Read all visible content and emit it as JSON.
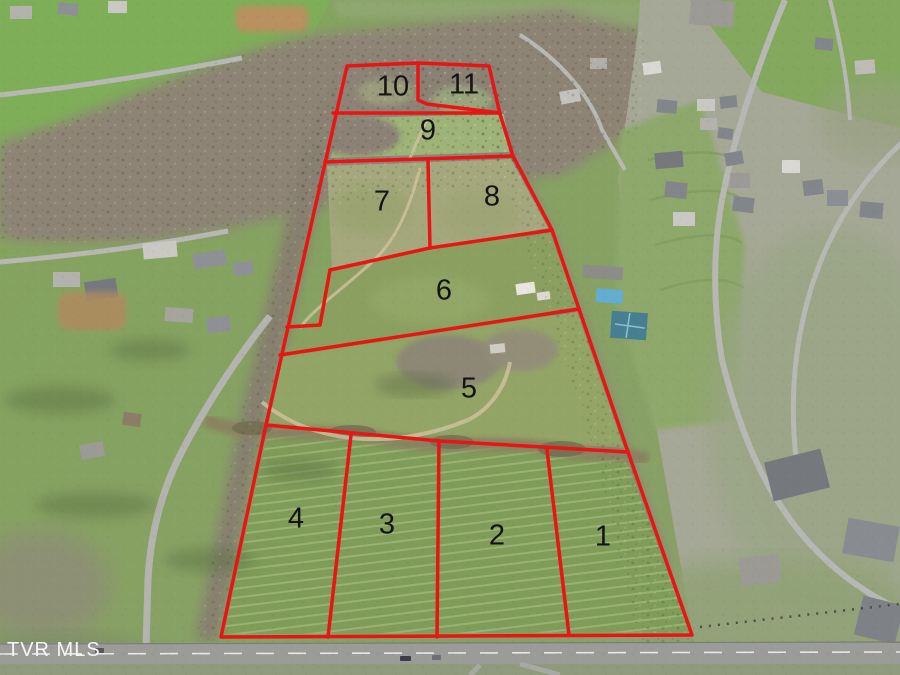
{
  "watermark": {
    "text": "TVR MLS"
  },
  "overlay": {
    "color": "#e91414",
    "stroke_width": 3.5,
    "parcels": [
      {
        "number": "1",
        "x": 603,
        "y": 537
      },
      {
        "number": "2",
        "x": 497,
        "y": 536
      },
      {
        "number": "3",
        "x": 387,
        "y": 525
      },
      {
        "number": "4",
        "x": 296,
        "y": 519
      },
      {
        "number": "5",
        "x": 469,
        "y": 389
      },
      {
        "number": "6",
        "x": 444,
        "y": 291
      },
      {
        "number": "7",
        "x": 382,
        "y": 202
      },
      {
        "number": "8",
        "x": 492,
        "y": 197
      },
      {
        "number": "9",
        "x": 428,
        "y": 131
      },
      {
        "number": "10",
        "x": 393,
        "y": 87
      },
      {
        "number": "11",
        "x": 464,
        "y": 85
      }
    ],
    "boundaries": [
      {
        "name": "outer-boundary",
        "points": "347,66 418,63 489,66 500,114 513,156 552,230 579,309 628,452 692,635 221,637 266,425 347,66"
      },
      {
        "name": "lot-10-11-divider",
        "points": "418,63 418,100 427,104 500,113"
      },
      {
        "name": "lot-9-north-line",
        "points": "333,113 500,113"
      },
      {
        "name": "lot-7-8-north-line",
        "points": "325,162 513,156"
      },
      {
        "name": "lot-7-8-divider",
        "points": "428,161 430,248"
      },
      {
        "name": "lot-6-north-line",
        "points": "330,270 430,248 552,230"
      },
      {
        "name": "lot-6-west-notch",
        "points": "287,327 320,325 330,270"
      },
      {
        "name": "lot-5-north-line",
        "points": "280,355 579,309"
      },
      {
        "name": "lot-1-4-north-line",
        "points": "266,425 440,441 628,452"
      },
      {
        "name": "lot-4-3-divider",
        "points": "351,435 328,637"
      },
      {
        "name": "lot-3-2-divider",
        "points": "439,441 437,637"
      },
      {
        "name": "lot-2-1-divider",
        "points": "547,450 569,635"
      }
    ]
  }
}
